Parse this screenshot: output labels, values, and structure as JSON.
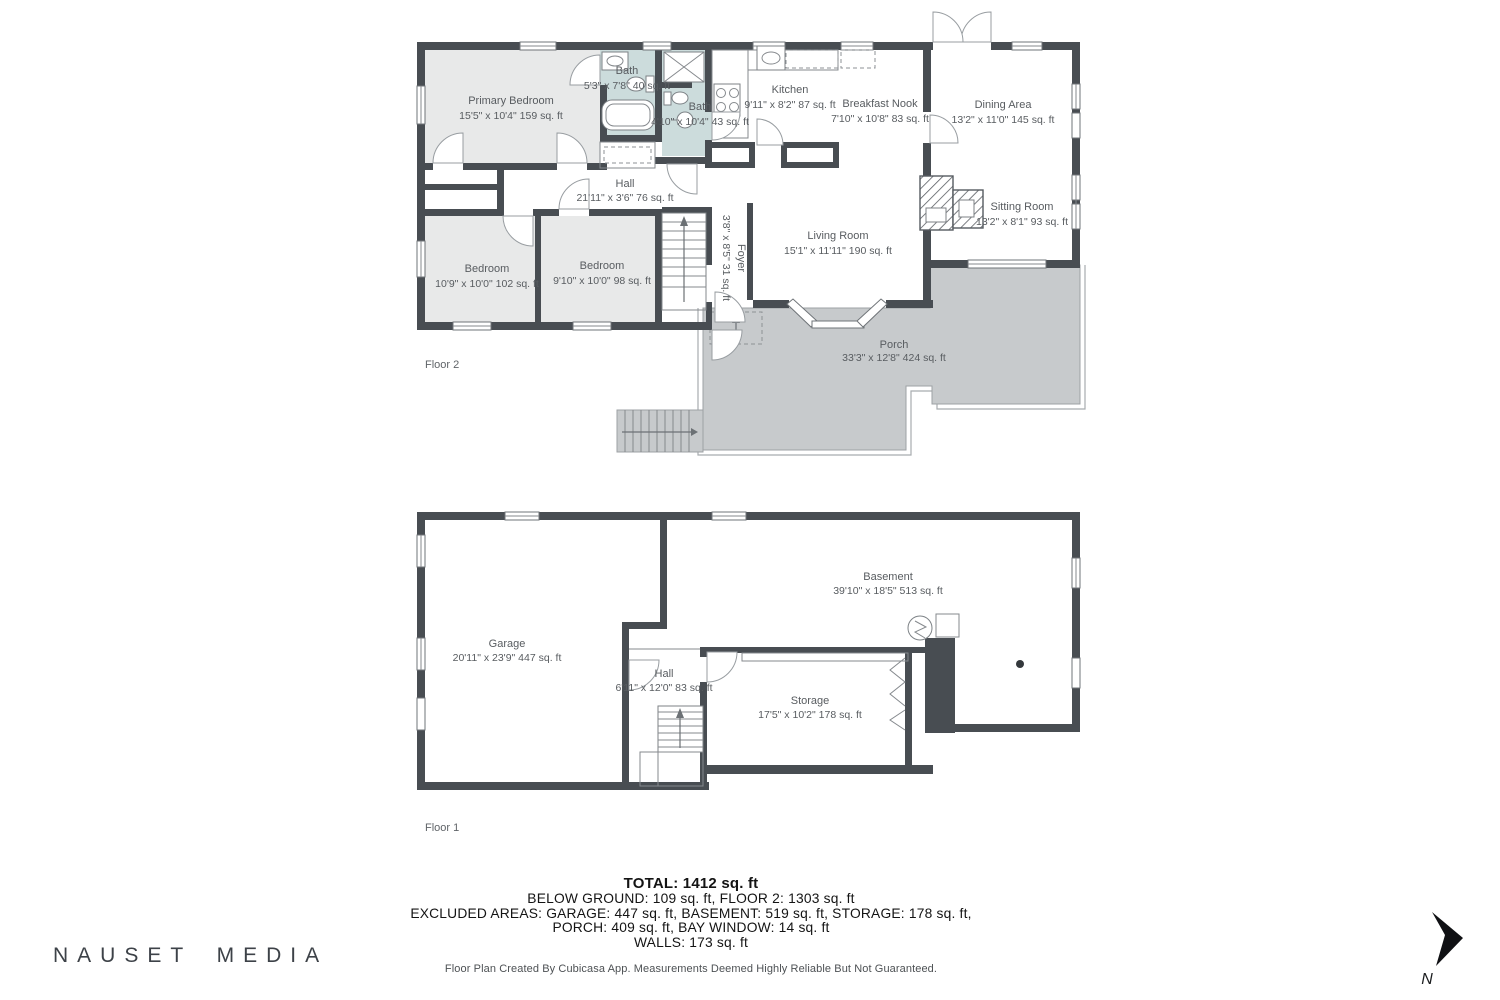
{
  "floor2": {
    "label": "Floor 2",
    "rooms": {
      "primary_bedroom": {
        "name": "Primary Bedroom",
        "dims": "15'5\" x 10'4\" 159 sq. ft"
      },
      "bath_a": {
        "name": "Bath",
        "dims": "5'3\" x 7'8\" 40 sq. ft"
      },
      "bath_b": {
        "name": "Bath",
        "dims": "4'10\" x 10'4\" 43 sq. ft"
      },
      "kitchen": {
        "name": "Kitchen",
        "dims": "9'11\" x 8'2\" 87 sq. ft"
      },
      "breakfast_nook": {
        "name": "Breakfast Nook",
        "dims": "7'10\" x 10'8\" 83 sq. ft"
      },
      "dining_area": {
        "name": "Dining Area",
        "dims": "13'2\" x 11'0\" 145 sq. ft"
      },
      "sitting_room": {
        "name": "Sitting Room",
        "dims": "13'2\" x 8'1\" 93 sq. ft"
      },
      "hall": {
        "name": "Hall",
        "dims": "21'11\" x 3'6\" 76 sq. ft"
      },
      "bedroom_a": {
        "name": "Bedroom",
        "dims": "10'9\" x 10'0\" 102 sq. ft"
      },
      "bedroom_b": {
        "name": "Bedroom",
        "dims": "9'10\" x 10'0\" 98 sq. ft"
      },
      "living_room": {
        "name": "Living Room",
        "dims": "15'1\" x 11'11\" 190 sq. ft"
      },
      "foyer": {
        "name": "Foyer",
        "dims": "3'8\" x 8'5\" 31 sq. ft"
      },
      "porch": {
        "name": "Porch",
        "dims": "33'3\" x 12'8\" 424 sq. ft"
      }
    }
  },
  "floor1": {
    "label": "Floor 1",
    "rooms": {
      "garage": {
        "name": "Garage",
        "dims": "20'11\" x 23'9\" 447 sq. ft"
      },
      "basement": {
        "name": "Basement",
        "dims": "39'10\" x 18'5\" 513 sq. ft"
      },
      "hall": {
        "name": "Hall",
        "dims": "6'11\" x 12'0\" 83 sq. ft"
      },
      "storage": {
        "name": "Storage",
        "dims": "17'5\" x 10'2\" 178 sq. ft"
      }
    }
  },
  "summary": {
    "total": "TOTAL: 1412 sq. ft",
    "below_ground": "BELOW GROUND: 109 sq. ft, FLOOR 2: 1303 sq. ft",
    "excluded": "EXCLUDED AREAS: GARAGE: 447 sq. ft, BASEMENT: 519 sq. ft, STORAGE: 178 sq. ft,",
    "excluded2": "PORCH: 409 sq. ft, BAY WINDOW: 14 sq. ft",
    "walls": "WALLS: 173 sq. ft",
    "disclaimer": "Floor Plan Created By Cubicasa App. Measurements Deemed Highly Reliable But Not Guaranteed."
  },
  "watermark": {
    "text": "NAUSET MEDIA"
  },
  "compass": {
    "label": "N"
  },
  "colors": {
    "wall": "#484d52",
    "room_fill": "#e8e9e9",
    "bath_fill": "#ccdcdc",
    "porch_fill": "#c7cacc"
  }
}
